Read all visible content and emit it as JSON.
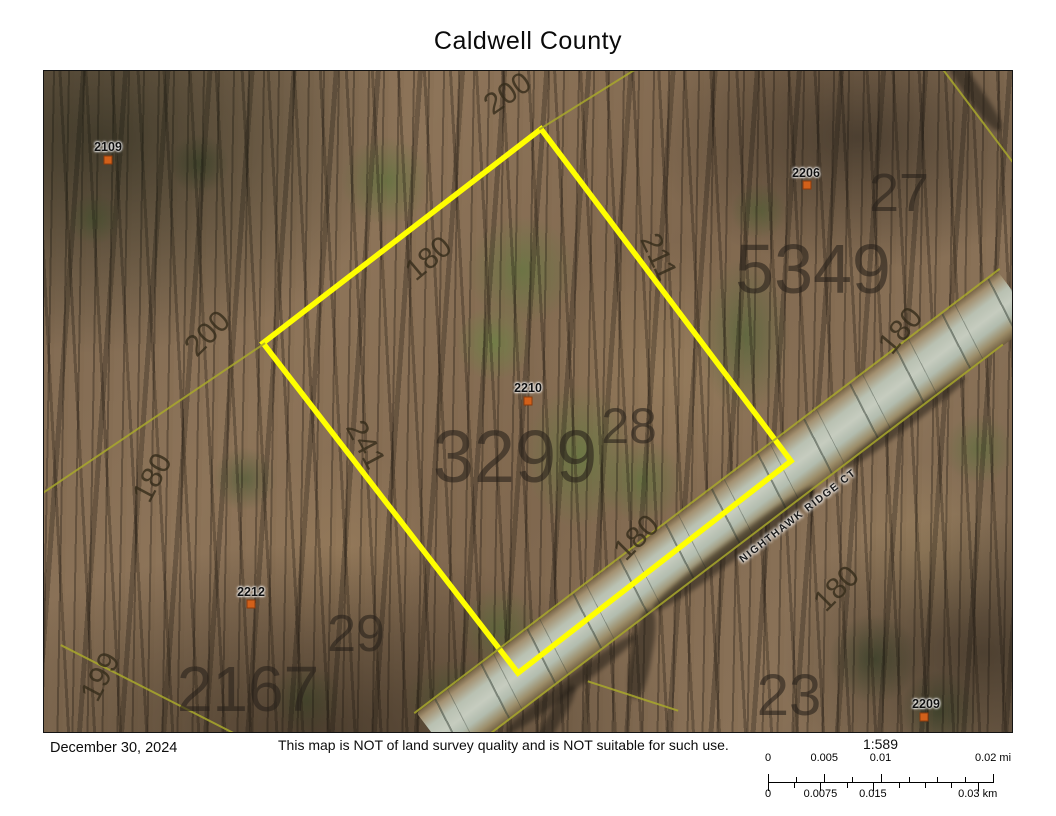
{
  "title": "Caldwell County",
  "map": {
    "road_label": "NIGHTHAWK RIDGE CT",
    "highlight_color": "#ffff00",
    "boundary_color": "#a8a82c",
    "marker_color": "#d2601a",
    "highlight_polygon": [
      [
        497,
        58
      ],
      [
        747,
        390
      ],
      [
        474,
        602
      ],
      [
        219,
        272
      ]
    ],
    "boundary_lines": [
      {
        "x": 544,
        "y": 28,
        "len": 115,
        "rot": -32
      },
      {
        "x": 110,
        "y": 347,
        "len": 268,
        "rot": -34
      },
      {
        "x": 105,
        "y": 619,
        "len": 198,
        "rot": 27
      },
      {
        "x": 934,
        "y": 45,
        "len": 115,
        "rot": 53
      },
      {
        "x": 663,
        "y": 420,
        "len": 735,
        "rot": -37.2
      },
      {
        "x": 700,
        "y": 470,
        "len": 650,
        "rot": -37.2
      },
      {
        "x": 589,
        "y": 625,
        "len": 95,
        "rot": 18
      }
    ],
    "point_labels": [
      {
        "text": "2109",
        "x": 64,
        "y": 76,
        "mx": 64,
        "my": 89
      },
      {
        "text": "2206",
        "x": 762,
        "y": 102,
        "mx": 763,
        "my": 114
      },
      {
        "text": "2210",
        "x": 484,
        "y": 317,
        "mx": 484,
        "my": 330
      },
      {
        "text": "2212",
        "x": 207,
        "y": 521,
        "mx": 207,
        "my": 533
      },
      {
        "text": "2209",
        "x": 882,
        "y": 633,
        "mx": 880,
        "my": 646
      }
    ],
    "large_numbers": [
      {
        "text": "27",
        "x": 855,
        "y": 122,
        "size": 54
      },
      {
        "text": "5349",
        "x": 769,
        "y": 198,
        "size": 70
      },
      {
        "text": "3299",
        "x": 471,
        "y": 386,
        "size": 74
      },
      {
        "text": "28",
        "x": 585,
        "y": 355,
        "size": 50
      },
      {
        "text": "29",
        "x": 312,
        "y": 563,
        "size": 52
      },
      {
        "text": "2167",
        "x": 204,
        "y": 618,
        "size": 64
      },
      {
        "text": "23",
        "x": 745,
        "y": 625,
        "size": 58
      }
    ],
    "dim_labels": [
      {
        "text": "200",
        "x": 464,
        "y": 23,
        "rot": -35
      },
      {
        "text": "180",
        "x": 385,
        "y": 188,
        "rot": -40
      },
      {
        "text": "211",
        "x": 614,
        "y": 186,
        "rot": 65
      },
      {
        "text": "200",
        "x": 164,
        "y": 263,
        "rot": -45
      },
      {
        "text": "180",
        "x": 109,
        "y": 407,
        "rot": -62
      },
      {
        "text": "241",
        "x": 321,
        "y": 374,
        "rot": 62
      },
      {
        "text": "180",
        "x": 593,
        "y": 467,
        "rot": -45
      },
      {
        "text": "180",
        "x": 857,
        "y": 260,
        "rot": -50
      },
      {
        "text": "180",
        "x": 793,
        "y": 518,
        "rot": -45
      },
      {
        "text": "199",
        "x": 57,
        "y": 606,
        "rot": -62
      }
    ]
  },
  "footer": {
    "date": "December 30, 2024",
    "disclaimer": "This map is NOT of land survey quality and is NOT suitable for such use."
  },
  "scale_bar": {
    "ratio": "1:589",
    "mi_ticks": [
      {
        "label": "0",
        "frac": 0
      },
      {
        "label": "0.005",
        "frac": 0.25
      },
      {
        "label": "0.01",
        "frac": 0.5
      },
      {
        "label": "0.02 mi",
        "frac": 1
      }
    ],
    "km_ticks": [
      {
        "label": "0",
        "frac": 0
      },
      {
        "label": "0.0075",
        "frac": 0.233
      },
      {
        "label": "0.015",
        "frac": 0.466
      },
      {
        "label": "0.03 km",
        "frac": 0.932
      }
    ]
  }
}
